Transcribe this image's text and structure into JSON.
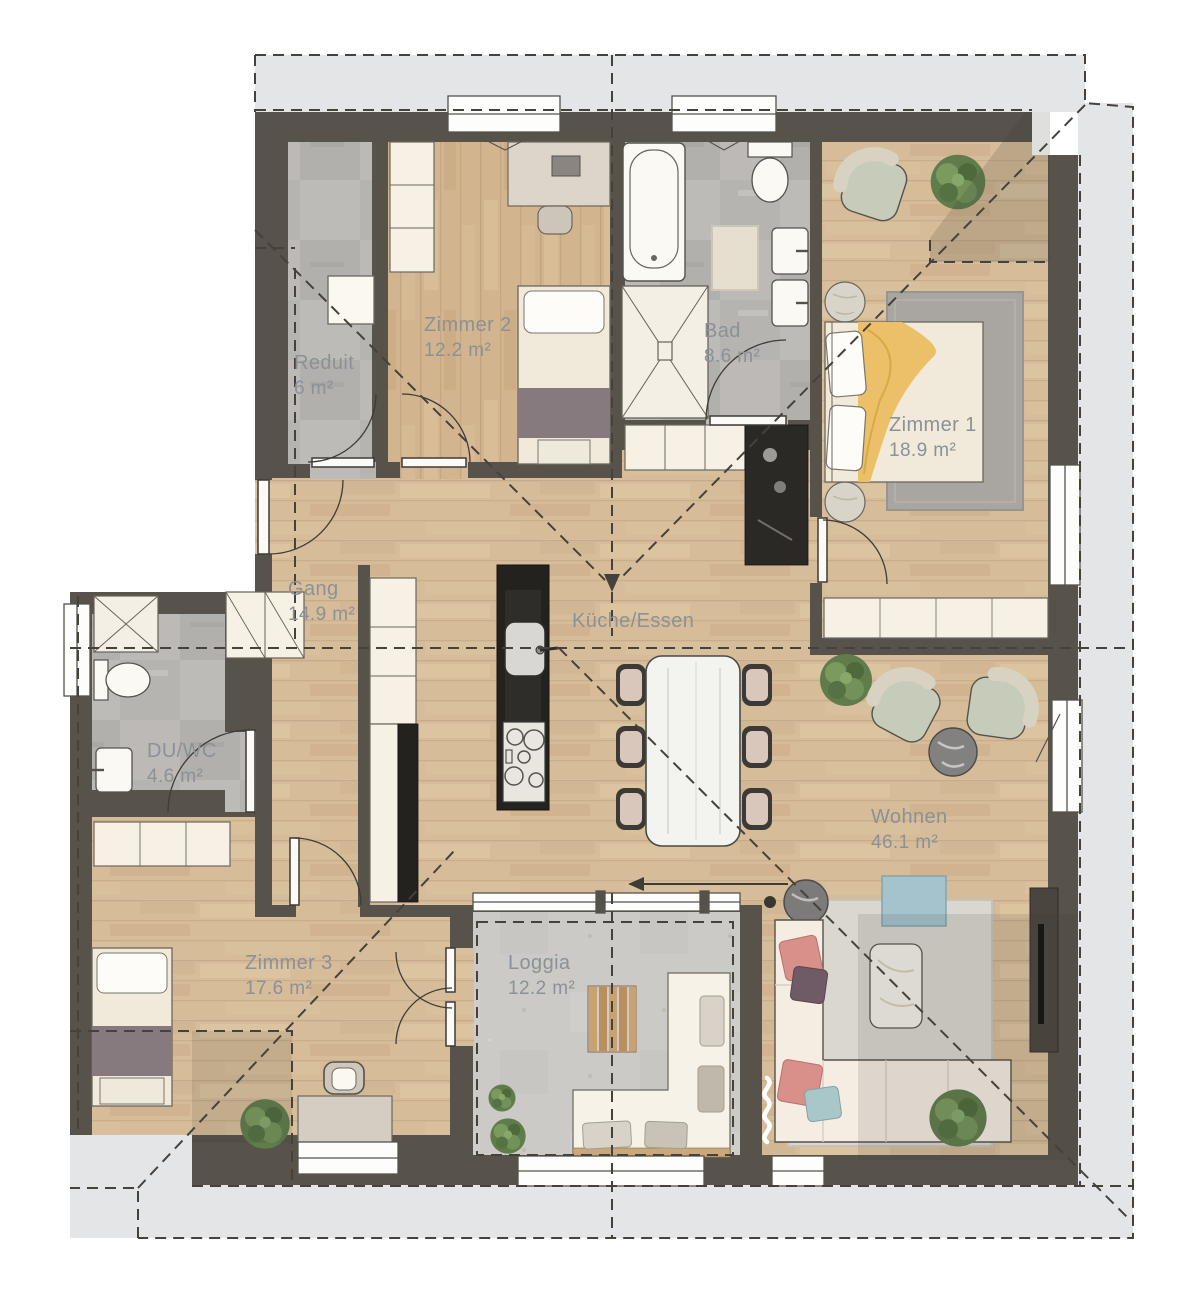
{
  "plan_title": "Wohnung Grundriss",
  "rooms": [
    {
      "id": "reduit",
      "name": "Reduit",
      "area": "6 m²"
    },
    {
      "id": "zimmer2",
      "name": "Zimmer 2",
      "area": "12.2 m²"
    },
    {
      "id": "bad",
      "name": "Bad",
      "area": "8.6 m²"
    },
    {
      "id": "zimmer1",
      "name": "Zimmer 1",
      "area": "18.9 m²"
    },
    {
      "id": "gang",
      "name": "Gang",
      "area": "14.9 m²"
    },
    {
      "id": "kueche",
      "name": "Küche/Essen",
      "area": ""
    },
    {
      "id": "duwc",
      "name": "DU/WC",
      "area": "4.6 m²"
    },
    {
      "id": "wohnen",
      "name": "Wohnen",
      "area": "46.1 m²"
    },
    {
      "id": "zimmer3",
      "name": "Zimmer 3",
      "area": "17.6 m²"
    },
    {
      "id": "loggia",
      "name": "Loggia",
      "area": "12.2 m²"
    }
  ],
  "palette": {
    "wall": "#57524a",
    "wood": "#d6bc99",
    "stone": "#b6b4b1",
    "concrete": "#cccac6",
    "roof_overhang": "#e4e5e7",
    "dash": "#45413b",
    "cream": "#f5f0e4",
    "accent_yellow": "#ecc068",
    "accent_blue": "#a5c3cd",
    "accent_green": "#c6ccb9",
    "accent_pink": "#d98f8a",
    "label": "#8b9197",
    "island_black": "#23221f"
  }
}
